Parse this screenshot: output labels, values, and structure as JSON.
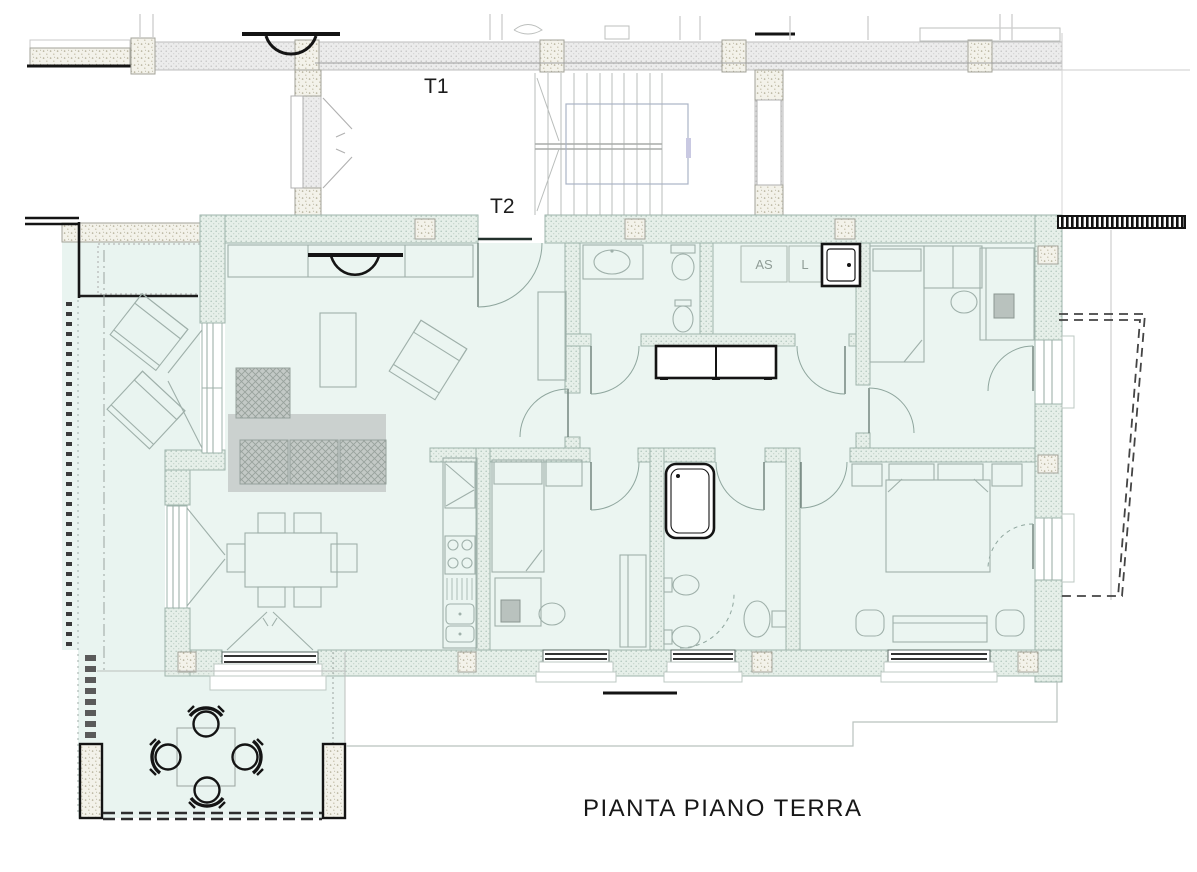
{
  "title": "PIANTA PIANO TERRA",
  "labels": {
    "stair_upper": "T1",
    "stair_lower": "T2"
  },
  "laundry": {
    "dryer": "AS",
    "washer": "L"
  },
  "colors": {
    "paper": "#ffffff",
    "floor_tint": "#ebf5f1",
    "wall_fill_green": "#e6efe9",
    "wall_fill_gray": "#ececec",
    "ink": "#141414",
    "furniture_line": "#9fb0aa",
    "upper_floor_line": "#bcbfbd",
    "rug": "#cbd1cf"
  }
}
